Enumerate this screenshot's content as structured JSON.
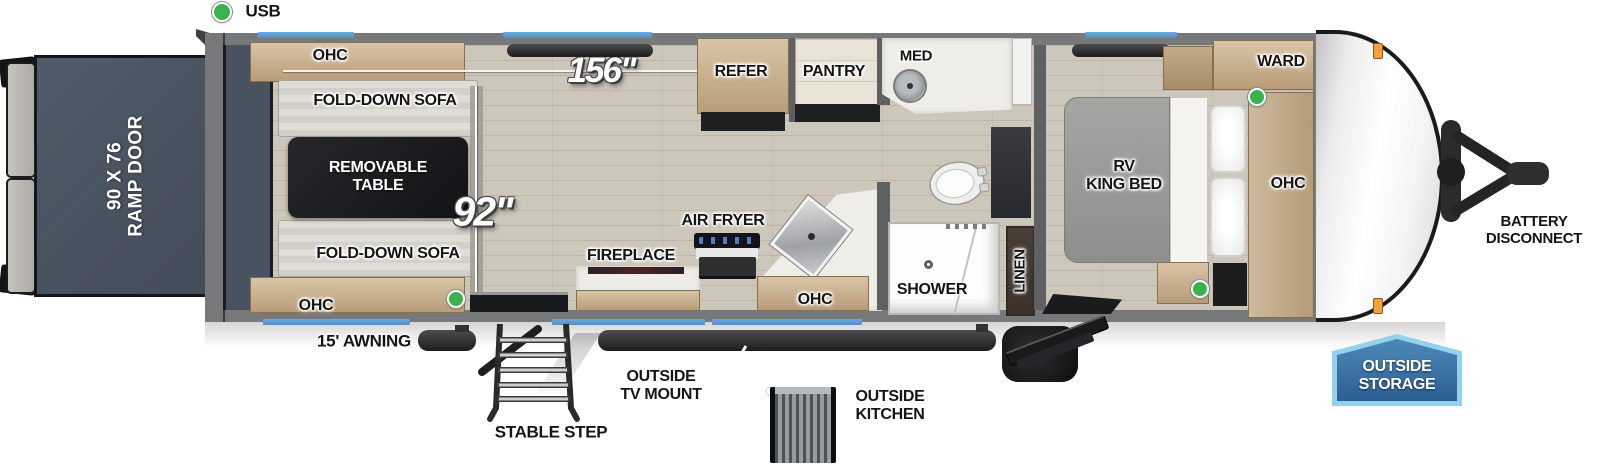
{
  "colors": {
    "window-blue": "#6fa8dc",
    "wall-gray": "#77787a",
    "floor-wood": "#cdc6ba",
    "ramp-slate": "#4d5665",
    "usb-green": "#3bb24a",
    "marker-orange": "#f2a13d",
    "badge-blue": "#36689c",
    "badge-blue-light": "#93d2ea"
  },
  "legend": {
    "usb": "USB"
  },
  "dims": {
    "main_length": "156\"",
    "garage_length": "92\""
  },
  "rear": {
    "ramp_line1": "90 X 76",
    "ramp_line2": "RAMP DOOR"
  },
  "garage": {
    "ohc_top": "OHC",
    "sofa_top": "FOLD-DOWN SOFA",
    "table_line1": "REMOVABLE",
    "table_line2": "TABLE",
    "sofa_bottom": "FOLD-DOWN SOFA",
    "ohc_bottom": "OHC"
  },
  "kitchen": {
    "refer": "REFER",
    "pantry": "PANTRY",
    "air_fryer": "AIR FRYER",
    "fireplace": "FIREPLACE",
    "ohc": "OHC"
  },
  "bath": {
    "med": "MED",
    "shower": "SHOWER",
    "linen": "LINEN"
  },
  "bedroom": {
    "bed_line1": "RV",
    "bed_line2": "KING BED",
    "ward": "WARD",
    "ohc": "OHC"
  },
  "front": {
    "battery_line1": "BATTERY",
    "battery_line2": "DISCONNECT"
  },
  "underbody": {
    "awning": "15' AWNING",
    "stable_step": "STABLE STEP",
    "tv_line1": "OUTSIDE",
    "tv_line2": "TV MOUNT",
    "kitchen_line1": "OUTSIDE",
    "kitchen_line2": "KITCHEN",
    "storage_line1": "OUTSIDE",
    "storage_line2": "STORAGE"
  }
}
